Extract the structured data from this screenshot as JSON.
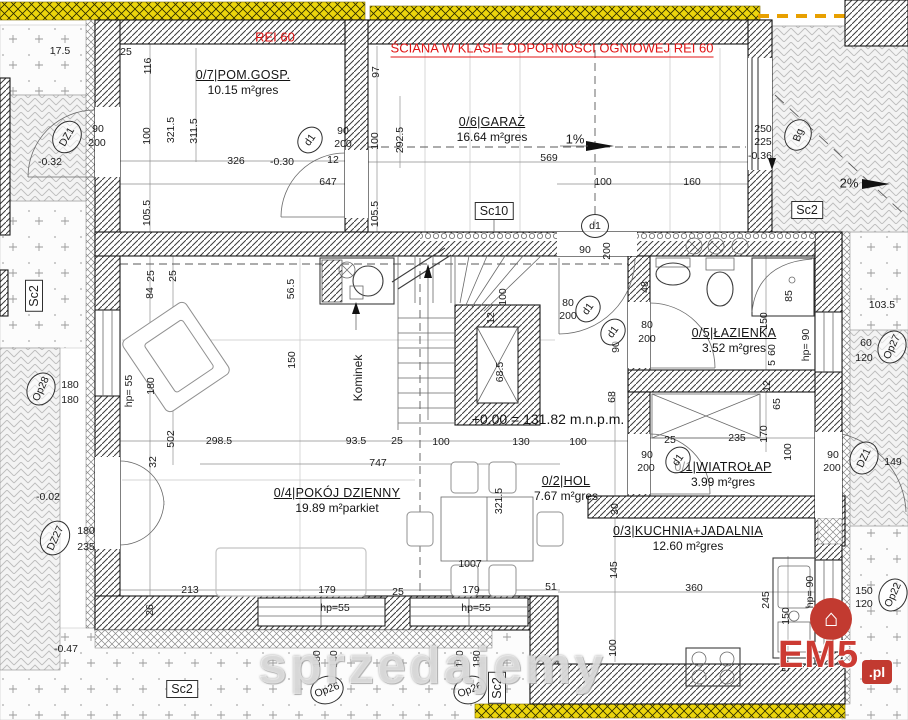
{
  "notes": {
    "rei": "REI 60",
    "fire_wall": "ŚCIANA W KLASIE ODPORNOŚCI OGNIOWEJ REI 60",
    "datum": "+0.00 = 131.82 m.n.p.m."
  },
  "watermark": {
    "text": "sprzedajemy"
  },
  "logo": {
    "brand": "EM5",
    "tld": ".pl",
    "icon": "house-icon"
  },
  "colors": {
    "fire_note_red": "#e01414",
    "insulation_yellow": "#eed60a",
    "wall_line": "#1c1c1c",
    "paving_gray": "#bdbdbd",
    "logo_red": "#c23a30"
  },
  "rooms": [
    {
      "num": "0/7",
      "name": "POM.GOSP.",
      "area": "10.15 m²",
      "floor": "gres",
      "x": 243,
      "y": 68
    },
    {
      "num": "0/6",
      "name": "GARAŻ",
      "area": "16.64 m²",
      "floor": "gres",
      "x": 492,
      "y": 115
    },
    {
      "num": "0/5",
      "name": "ŁAZIENKA",
      "area": "3.52 m²",
      "floor": "gres",
      "x": 734,
      "y": 326
    },
    {
      "num": "0/4",
      "name": "POKÓJ DZIENNY",
      "area": "19.89 m²",
      "floor": "parkiet",
      "x": 337,
      "y": 486
    },
    {
      "num": "0/2",
      "name": "HOL",
      "area": "7.67 m²",
      "floor": "gres",
      "x": 566,
      "y": 474
    },
    {
      "num": "0/1",
      "name": "WIATROŁAP",
      "area": "3.99 m²",
      "floor": "gres",
      "x": 723,
      "y": 460
    },
    {
      "num": "0/3",
      "name": "KUCHNIA+JADALNIA",
      "area": "12.60 m²",
      "floor": "gres",
      "x": 688,
      "y": 524
    }
  ],
  "markers": [
    {
      "t": "DZ1",
      "x": 67,
      "y": 137,
      "shape": "circle",
      "r": -60,
      "w": 32,
      "h": 26
    },
    {
      "t": "d1",
      "x": 310,
      "y": 140,
      "shape": "circle",
      "r": -55,
      "w": 26,
      "h": 22
    },
    {
      "t": "d1",
      "x": 595,
      "y": 226,
      "shape": "circle",
      "r": 0,
      "w": 26,
      "h": 22
    },
    {
      "t": "d1",
      "x": 588,
      "y": 309,
      "shape": "circle",
      "r": -55,
      "w": 26,
      "h": 22
    },
    {
      "t": "d1",
      "x": 613,
      "y": 332,
      "shape": "circle",
      "r": -55,
      "w": 26,
      "h": 22
    },
    {
      "t": "d1",
      "x": 678,
      "y": 460,
      "shape": "circle",
      "r": -55,
      "w": 26,
      "h": 22
    },
    {
      "t": "Bg",
      "x": 798,
      "y": 135,
      "shape": "circle",
      "r": -70,
      "w": 30,
      "h": 25
    },
    {
      "t": "Op28",
      "x": 41,
      "y": 389,
      "shape": "circle",
      "r": -65,
      "w": 32,
      "h": 26
    },
    {
      "t": "Op26",
      "x": 327,
      "y": 690,
      "shape": "circle",
      "r": -20,
      "w": 32,
      "h": 26
    },
    {
      "t": "Op26",
      "x": 470,
      "y": 690,
      "shape": "circle",
      "r": -20,
      "w": 32,
      "h": 26
    },
    {
      "t": "Op27",
      "x": 892,
      "y": 347,
      "shape": "circle",
      "r": -65,
      "w": 32,
      "h": 26
    },
    {
      "t": "Op22",
      "x": 893,
      "y": 595,
      "shape": "circle",
      "r": -65,
      "w": 32,
      "h": 26
    },
    {
      "t": "DZ27",
      "x": 55,
      "y": 538,
      "shape": "circle",
      "r": -65,
      "w": 34,
      "h": 27
    },
    {
      "t": "DZ1",
      "x": 864,
      "y": 458,
      "shape": "circle",
      "r": -65,
      "w": 32,
      "h": 26
    },
    {
      "t": "Sc10",
      "x": 494,
      "y": 211,
      "shape": "box",
      "r": 0
    },
    {
      "t": "Sc2",
      "x": 34,
      "y": 296,
      "shape": "box",
      "r": -90
    },
    {
      "t": "Sc2",
      "x": 807,
      "y": 210,
      "shape": "box",
      "r": 0
    },
    {
      "t": "Sc2",
      "x": 182,
      "y": 689,
      "shape": "box",
      "r": 0
    },
    {
      "t": "Sc2",
      "x": 497,
      "y": 688,
      "shape": "box",
      "r": -90
    }
  ],
  "dimensions": [
    {
      "t": "17.5",
      "x": 60,
      "y": 51
    },
    {
      "t": "25",
      "x": 126,
      "y": 52
    },
    {
      "t": "116",
      "x": 148,
      "y": 66,
      "r": -90
    },
    {
      "t": "100",
      "x": 147,
      "y": 136,
      "r": -90
    },
    {
      "t": "321.5",
      "x": 171,
      "y": 130,
      "r": -90
    },
    {
      "t": "311.5",
      "x": 194,
      "y": 131,
      "r": -90
    },
    {
      "t": "90",
      "x": 343,
      "y": 131
    },
    {
      "t": "200",
      "x": 343,
      "y": 144
    },
    {
      "t": "12",
      "x": 333,
      "y": 160
    },
    {
      "t": "326",
      "x": 236,
      "y": 161
    },
    {
      "t": "-0.30",
      "x": 282,
      "y": 162
    },
    {
      "t": "647",
      "x": 328,
      "y": 182
    },
    {
      "t": "105.5",
      "x": 147,
      "y": 213,
      "r": -90
    },
    {
      "t": "105.5",
      "x": 375,
      "y": 214,
      "r": -90
    },
    {
      "t": "97",
      "x": 376,
      "y": 72,
      "r": -90
    },
    {
      "t": "100",
      "x": 375,
      "y": 141,
      "r": -90
    },
    {
      "t": "292.5",
      "x": 400,
      "y": 140,
      "r": -90
    },
    {
      "t": "569",
      "x": 549,
      "y": 158
    },
    {
      "t": "1%",
      "x": 575,
      "y": 139,
      "f": 13
    },
    {
      "t": "100",
      "x": 603,
      "y": 182
    },
    {
      "t": "160",
      "x": 692,
      "y": 182
    },
    {
      "t": "250",
      "x": 763,
      "y": 129
    },
    {
      "t": "225",
      "x": 763,
      "y": 142
    },
    {
      "t": "-0.36",
      "x": 760,
      "y": 156
    },
    {
      "t": "2%",
      "x": 849,
      "y": 183,
      "f": 13
    },
    {
      "t": "90",
      "x": 98,
      "y": 129
    },
    {
      "t": "200",
      "x": 97,
      "y": 143
    },
    {
      "t": "-0.32",
      "x": 50,
      "y": 162
    },
    {
      "t": "103.5",
      "x": 882,
      "y": 305
    },
    {
      "t": "60",
      "x": 866,
      "y": 343
    },
    {
      "t": "120",
      "x": 864,
      "y": 358
    },
    {
      "t": "25",
      "x": 173,
      "y": 276,
      "r": -90
    },
    {
      "t": "25",
      "x": 151,
      "y": 276,
      "r": -90
    },
    {
      "t": "84",
      "x": 150,
      "y": 293,
      "r": -90
    },
    {
      "t": "56.5",
      "x": 291,
      "y": 289,
      "r": -90
    },
    {
      "t": "150",
      "x": 292,
      "y": 360,
      "r": -90
    },
    {
      "t": "180",
      "x": 151,
      "y": 386,
      "r": -90
    },
    {
      "t": "hp= 55",
      "x": 129,
      "y": 391,
      "r": -90
    },
    {
      "t": "502",
      "x": 171,
      "y": 439,
      "r": -90
    },
    {
      "t": "32",
      "x": 153,
      "y": 462,
      "r": -90
    },
    {
      "t": "298.5",
      "x": 219,
      "y": 441
    },
    {
      "t": "93.5",
      "x": 356,
      "y": 441
    },
    {
      "t": "25",
      "x": 397,
      "y": 441
    },
    {
      "t": "747",
      "x": 378,
      "y": 463
    },
    {
      "t": "100",
      "x": 441,
      "y": 442
    },
    {
      "t": "130",
      "x": 521,
      "y": 442
    },
    {
      "t": "100",
      "x": 578,
      "y": 442
    },
    {
      "t": "90",
      "x": 585,
      "y": 250
    },
    {
      "t": "200",
      "x": 607,
      "y": 251,
      "r": -90
    },
    {
      "t": "48",
      "x": 645,
      "y": 287,
      "r": -90
    },
    {
      "t": "80",
      "x": 568,
      "y": 303
    },
    {
      "t": "200",
      "x": 568,
      "y": 316
    },
    {
      "t": "80",
      "x": 647,
      "y": 325
    },
    {
      "t": "200",
      "x": 647,
      "y": 339
    },
    {
      "t": "100",
      "x": 503,
      "y": 297,
      "r": -90
    },
    {
      "t": "12",
      "x": 491,
      "y": 318,
      "r": -90
    },
    {
      "t": "68.5",
      "x": 500,
      "y": 372,
      "r": -90
    },
    {
      "t": "90",
      "x": 616,
      "y": 347,
      "r": -90
    },
    {
      "t": "68",
      "x": 612,
      "y": 397,
      "r": -90
    },
    {
      "t": "Kominek",
      "x": 358,
      "y": 378,
      "r": -90,
      "f": 12
    },
    {
      "t": "85",
      "x": 789,
      "y": 296,
      "r": -90
    },
    {
      "t": "150",
      "x": 764,
      "y": 321,
      "r": -90
    },
    {
      "t": "60",
      "x": 772,
      "y": 350,
      "r": -90
    },
    {
      "t": "5",
      "x": 772,
      "y": 363,
      "r": -90
    },
    {
      "t": "hp= 90",
      "x": 806,
      "y": 345,
      "r": -90
    },
    {
      "t": "12",
      "x": 767,
      "y": 386,
      "r": -90
    },
    {
      "t": "65",
      "x": 777,
      "y": 404,
      "r": -90
    },
    {
      "t": "170",
      "x": 764,
      "y": 434,
      "r": -90
    },
    {
      "t": "100",
      "x": 788,
      "y": 452,
      "r": -90
    },
    {
      "t": "25",
      "x": 670,
      "y": 440
    },
    {
      "t": "235",
      "x": 737,
      "y": 438
    },
    {
      "t": "90",
      "x": 647,
      "y": 455
    },
    {
      "t": "200",
      "x": 646,
      "y": 468
    },
    {
      "t": "90",
      "x": 833,
      "y": 455
    },
    {
      "t": "200",
      "x": 832,
      "y": 468
    },
    {
      "t": "149",
      "x": 893,
      "y": 462
    },
    {
      "t": "321.5",
      "x": 499,
      "y": 501,
      "r": -90
    },
    {
      "t": "1007",
      "x": 470,
      "y": 564
    },
    {
      "t": "30",
      "x": 615,
      "y": 509,
      "r": -90
    },
    {
      "t": "145",
      "x": 614,
      "y": 570,
      "r": -90
    },
    {
      "t": "100",
      "x": 613,
      "y": 648,
      "r": -90
    },
    {
      "t": "360",
      "x": 694,
      "y": 588
    },
    {
      "t": "245",
      "x": 766,
      "y": 600,
      "r": -90
    },
    {
      "t": "150",
      "x": 786,
      "y": 616,
      "r": -90
    },
    {
      "t": "hp= 90",
      "x": 810,
      "y": 592,
      "r": -90
    },
    {
      "t": "55",
      "x": 786,
      "y": 666,
      "r": -90
    },
    {
      "t": "150",
      "x": 864,
      "y": 591
    },
    {
      "t": "120",
      "x": 864,
      "y": 604
    },
    {
      "t": "213",
      "x": 190,
      "y": 590
    },
    {
      "t": "26",
      "x": 150,
      "y": 610,
      "r": -90
    },
    {
      "t": "179",
      "x": 327,
      "y": 590
    },
    {
      "t": "hp=55",
      "x": 335,
      "y": 608
    },
    {
      "t": "25",
      "x": 398,
      "y": 592
    },
    {
      "t": "179",
      "x": 471,
      "y": 590
    },
    {
      "t": "hp=55",
      "x": 476,
      "y": 608
    },
    {
      "t": "51",
      "x": 551,
      "y": 587
    },
    {
      "t": "180",
      "x": 317,
      "y": 659,
      "r": -90
    },
    {
      "t": "180",
      "x": 334,
      "y": 659,
      "r": -90
    },
    {
      "t": "180",
      "x": 460,
      "y": 659,
      "r": -90
    },
    {
      "t": "180",
      "x": 477,
      "y": 659,
      "r": -90
    },
    {
      "t": "180",
      "x": 70,
      "y": 385
    },
    {
      "t": "180",
      "x": 70,
      "y": 400
    },
    {
      "t": "180",
      "x": 86,
      "y": 531
    },
    {
      "t": "235",
      "x": 86,
      "y": 547
    },
    {
      "t": "-0.02",
      "x": 48,
      "y": 497
    },
    {
      "t": "-0.47",
      "x": 66,
      "y": 649
    }
  ]
}
